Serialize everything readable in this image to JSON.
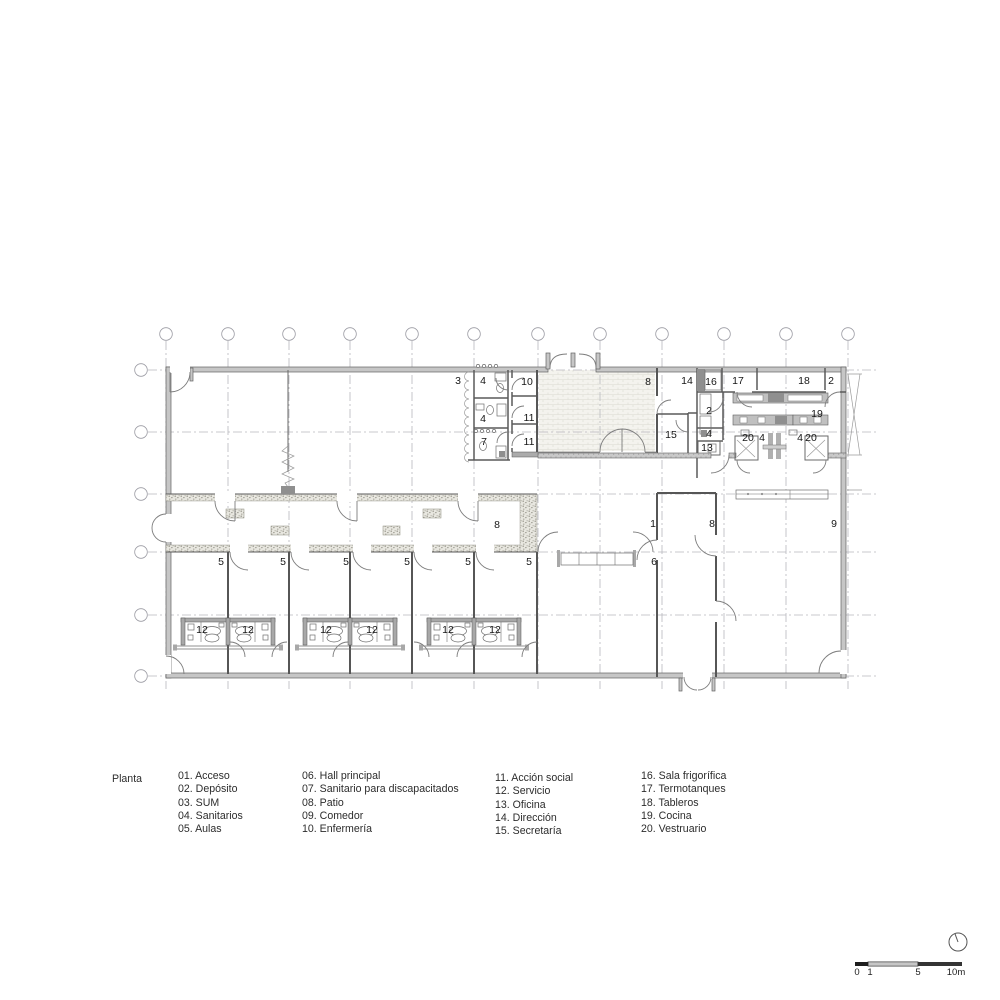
{
  "document": {
    "type": "architectural-floor-plan",
    "title": "Planta"
  },
  "legend": {
    "title": "Planta",
    "columns": [
      [
        "01. Acceso",
        "02. Depósito",
        "03. SUM",
        "04. Sanitarios",
        "05. Aulas"
      ],
      [
        "06. Hall principal",
        "07. Sanitario para discapacitados",
        "08. Patio",
        "09. Comedor",
        "10. Enfermería"
      ],
      [
        "11. Acción social",
        "12. Servicio",
        "13. Oficina",
        "14. Dirección",
        "15. Secretaría"
      ],
      [
        "16. Sala frigorífica",
        "17. Termotanques",
        "18. Tableros",
        "19. Cocina",
        "20. Vestruario"
      ]
    ]
  },
  "plan": {
    "room_labels": [
      {
        "text": "3",
        "x": 458,
        "y": 384
      },
      {
        "text": "4",
        "x": 483,
        "y": 384
      },
      {
        "text": "10",
        "x": 527,
        "y": 385
      },
      {
        "text": "4",
        "x": 483,
        "y": 422
      },
      {
        "text": "11",
        "x": 529,
        "y": 421
      },
      {
        "text": "7",
        "x": 484,
        "y": 445
      },
      {
        "text": "11",
        "x": 529,
        "y": 445
      },
      {
        "text": "8",
        "x": 648,
        "y": 385
      },
      {
        "text": "14",
        "x": 687,
        "y": 384
      },
      {
        "text": "16",
        "x": 711,
        "y": 385
      },
      {
        "text": "17",
        "x": 738,
        "y": 384
      },
      {
        "text": "18",
        "x": 804,
        "y": 384
      },
      {
        "text": "2",
        "x": 831,
        "y": 384
      },
      {
        "text": "2",
        "x": 709,
        "y": 414
      },
      {
        "text": "19",
        "x": 817,
        "y": 417
      },
      {
        "text": "15",
        "x": 671,
        "y": 438
      },
      {
        "text": "4",
        "x": 709,
        "y": 437
      },
      {
        "text": "13",
        "x": 707,
        "y": 451
      },
      {
        "text": "20",
        "x": 748,
        "y": 441
      },
      {
        "text": "4",
        "x": 762,
        "y": 441
      },
      {
        "text": "4",
        "x": 800,
        "y": 441
      },
      {
        "text": "20",
        "x": 811,
        "y": 441
      },
      {
        "text": "8",
        "x": 497,
        "y": 528
      },
      {
        "text": "5",
        "x": 221,
        "y": 565
      },
      {
        "text": "5",
        "x": 283,
        "y": 565
      },
      {
        "text": "5",
        "x": 346,
        "y": 565
      },
      {
        "text": "5",
        "x": 407,
        "y": 565
      },
      {
        "text": "5",
        "x": 468,
        "y": 565
      },
      {
        "text": "5",
        "x": 529,
        "y": 565
      },
      {
        "text": "1",
        "x": 653,
        "y": 527
      },
      {
        "text": "8",
        "x": 712,
        "y": 527
      },
      {
        "text": "9",
        "x": 834,
        "y": 527
      },
      {
        "text": "6",
        "x": 654,
        "y": 565
      },
      {
        "text": "12",
        "x": 202,
        "y": 633
      },
      {
        "text": "12",
        "x": 248,
        "y": 633
      },
      {
        "text": "12",
        "x": 326,
        "y": 633
      },
      {
        "text": "12",
        "x": 372,
        "y": 633
      },
      {
        "text": "12",
        "x": 448,
        "y": 633
      },
      {
        "text": "12",
        "x": 495,
        "y": 633
      }
    ]
  },
  "scalebar": {
    "tick_0": "0",
    "tick_1": "1",
    "tick_5": "5",
    "tick_10": "10m"
  },
  "colors": {
    "wall_fill": "#c6c6c6",
    "wall_edge": "#636363",
    "grid_line": "#b8b8be",
    "stipple_bg": "#e8e7e0",
    "patio_bg": "#f4f3ee",
    "dark_fixture": "#8f8f8f",
    "label_text": "#161616"
  }
}
